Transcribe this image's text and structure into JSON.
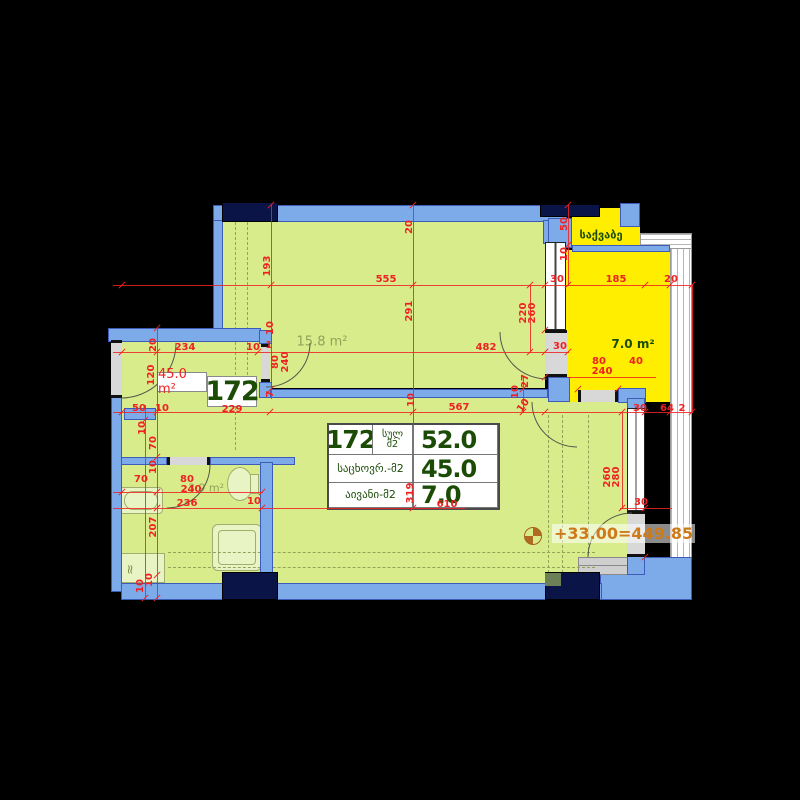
{
  "colors": {
    "wall_blue": "#7dabe9",
    "wall_outline": "#3c5cb8",
    "structure_navy": "#0b1446",
    "floor_green": "#d9ec8c",
    "balcony_yellow": "#ffee00",
    "dimension_red": "#ee2222",
    "label_dark_green": "#1b4c06",
    "label_olive": "#93a259",
    "level_orange": "#cf7a1a",
    "door_gray": "#d8d8d8"
  },
  "apartment": {
    "number": "172",
    "area_badge": "45.0 m²"
  },
  "table": {
    "apt_number": "172",
    "total_label_line1": "სულ",
    "total_label_line2": "მ2",
    "total_value": "52.0",
    "living_label": "საცხოვრ.-მ2",
    "living_value": "45.0",
    "balcony_label": "აივანი-მ2",
    "balcony_value": "7.0"
  },
  "level_mark": {
    "text": "+33.00=449.85"
  },
  "washer_symbol": "≈",
  "room_labels": [
    {
      "t": "15.8 m²",
      "x": 322,
      "y": 342,
      "c": "olive",
      "s": 13
    },
    {
      "t": "3.9 m²",
      "x": 206,
      "y": 488,
      "c": "olive",
      "s": 11
    },
    {
      "t": "7.0 m²",
      "x": 633,
      "y": 344,
      "c": "dg",
      "s": 12
    },
    {
      "t": "საქვაბე",
      "x": 601,
      "y": 235,
      "c": "dg",
      "s": 11
    }
  ],
  "dimension_labels": [
    {
      "t": "20",
      "x": 410,
      "y": 227,
      "r": -90
    },
    {
      "t": "193",
      "x": 268,
      "y": 266,
      "r": -90
    },
    {
      "t": "555",
      "x": 386,
      "y": 280,
      "r": 0
    },
    {
      "t": "291",
      "x": 410,
      "y": 311,
      "r": -90
    },
    {
      "t": "220",
      "x": 524,
      "y": 313,
      "r": -90
    },
    {
      "t": "260",
      "x": 533,
      "y": 313,
      "r": -90
    },
    {
      "t": "50",
      "x": 565,
      "y": 224,
      "r": -90
    },
    {
      "t": "10",
      "x": 565,
      "y": 254,
      "r": -90
    },
    {
      "t": "30",
      "x": 557,
      "y": 280,
      "r": 0
    },
    {
      "t": "185",
      "x": 616,
      "y": 280,
      "r": 0
    },
    {
      "t": "20",
      "x": 671,
      "y": 280,
      "r": 0
    },
    {
      "t": "20",
      "x": 154,
      "y": 345,
      "r": -90
    },
    {
      "t": "234",
      "x": 185,
      "y": 348,
      "r": 0
    },
    {
      "t": "10",
      "x": 253,
      "y": 348,
      "r": 0
    },
    {
      "t": "10",
      "x": 271,
      "y": 328,
      "r": -90
    },
    {
      "t": "1",
      "x": 269,
      "y": 346,
      "r": 0
    },
    {
      "t": "482",
      "x": 486,
      "y": 348,
      "r": 0
    },
    {
      "t": "30",
      "x": 560,
      "y": 347,
      "r": 0
    },
    {
      "t": "120",
      "x": 152,
      "y": 375,
      "r": -90
    },
    {
      "t": "80",
      "x": 276,
      "y": 362,
      "r": -90
    },
    {
      "t": "240",
      "x": 286,
      "y": 362,
      "r": -90
    },
    {
      "t": "7",
      "x": 271,
      "y": 394,
      "r": -90
    },
    {
      "t": "80",
      "x": 599,
      "y": 362,
      "r": 0
    },
    {
      "t": "240",
      "x": 602,
      "y": 372,
      "r": 0
    },
    {
      "t": "40",
      "x": 636,
      "y": 362,
      "r": 0
    },
    {
      "t": "27",
      "x": 526,
      "y": 381,
      "r": -90
    },
    {
      "t": "10",
      "x": 516,
      "y": 392,
      "r": -90
    },
    {
      "t": "10",
      "x": 524,
      "y": 406,
      "r": -55
    },
    {
      "t": "10",
      "x": 412,
      "y": 400,
      "r": -90
    },
    {
      "t": "50",
      "x": 139,
      "y": 409,
      "r": 0
    },
    {
      "t": "10",
      "x": 162,
      "y": 409,
      "r": 0
    },
    {
      "t": "229",
      "x": 232,
      "y": 410,
      "r": 0
    },
    {
      "t": "567",
      "x": 459,
      "y": 408,
      "r": 0
    },
    {
      "t": "30",
      "x": 640,
      "y": 409,
      "r": 0
    },
    {
      "t": "64",
      "x": 667,
      "y": 409,
      "r": 0
    },
    {
      "t": "2",
      "x": 682,
      "y": 409,
      "r": 0
    },
    {
      "t": "10",
      "x": 143,
      "y": 428,
      "r": -90
    },
    {
      "t": "70",
      "x": 154,
      "y": 443,
      "r": -90
    },
    {
      "t": "10",
      "x": 154,
      "y": 467,
      "r": -90
    },
    {
      "t": "70",
      "x": 141,
      "y": 480,
      "r": 0
    },
    {
      "t": "80",
      "x": 187,
      "y": 480,
      "r": 0
    },
    {
      "t": "240",
      "x": 191,
      "y": 490,
      "r": 0
    },
    {
      "t": "236",
      "x": 187,
      "y": 504,
      "r": 0
    },
    {
      "t": "10",
      "x": 254,
      "y": 502,
      "r": 0
    },
    {
      "t": "207",
      "x": 154,
      "y": 527,
      "r": -90
    },
    {
      "t": "260",
      "x": 608,
      "y": 477,
      "r": -90
    },
    {
      "t": "280",
      "x": 617,
      "y": 477,
      "r": -90
    },
    {
      "t": "30",
      "x": 641,
      "y": 503,
      "r": 0
    },
    {
      "t": "319",
      "x": 411,
      "y": 493,
      "r": -90
    },
    {
      "t": "610",
      "x": 447,
      "y": 505,
      "r": 0
    },
    {
      "t": "10",
      "x": 150,
      "y": 580,
      "r": -90
    },
    {
      "t": "10",
      "x": 141,
      "y": 586,
      "r": -90
    }
  ],
  "dimension_lines": [
    {
      "x": 113,
      "y": 285,
      "w": 580,
      "h": 1
    },
    {
      "x": 113,
      "y": 352,
      "w": 456,
      "h": 1
    },
    {
      "x": 113,
      "y": 412,
      "w": 580,
      "h": 1
    },
    {
      "x": 568,
      "y": 377,
      "w": 88,
      "h": 1
    },
    {
      "x": 113,
      "y": 492,
      "w": 150,
      "h": 1
    },
    {
      "x": 113,
      "y": 508,
      "w": 352,
      "h": 1
    },
    {
      "x": 620,
      "y": 508,
      "w": 52,
      "h": 1
    },
    {
      "x": 157,
      "y": 328,
      "w": 1,
      "h": 272
    },
    {
      "x": 145,
      "y": 405,
      "w": 1,
      "h": 195
    },
    {
      "x": 271,
      "y": 205,
      "w": 1,
      "h": 194
    },
    {
      "x": 413,
      "y": 205,
      "w": 1,
      "h": 305
    },
    {
      "x": 530,
      "y": 285,
      "w": 1,
      "h": 68
    },
    {
      "x": 568,
      "y": 205,
      "w": 1,
      "h": 81
    },
    {
      "x": 622,
      "y": 412,
      "w": 1,
      "h": 97
    },
    {
      "x": 523,
      "y": 377,
      "w": 1,
      "h": 36
    },
    {
      "x": 692,
      "y": 285,
      "w": 1,
      "h": 128
    }
  ],
  "ticks": [
    [
      122,
      285
    ],
    [
      271,
      285
    ],
    [
      413,
      285
    ],
    [
      530,
      285
    ],
    [
      545,
      285
    ],
    [
      568,
      285
    ],
    [
      645,
      285
    ],
    [
      670,
      285
    ],
    [
      692,
      285
    ],
    [
      122,
      352
    ],
    [
      157,
      352
    ],
    [
      258,
      352
    ],
    [
      530,
      352
    ],
    [
      545,
      352
    ],
    [
      568,
      352
    ],
    [
      122,
      412
    ],
    [
      157,
      412
    ],
    [
      270,
      412
    ],
    [
      413,
      412
    ],
    [
      545,
      412
    ],
    [
      622,
      412
    ],
    [
      645,
      412
    ],
    [
      670,
      412
    ],
    [
      692,
      412
    ],
    [
      122,
      492
    ],
    [
      157,
      492
    ],
    [
      262,
      492
    ],
    [
      157,
      508
    ],
    [
      262,
      508
    ],
    [
      413,
      508
    ],
    [
      622,
      508
    ],
    [
      645,
      508
    ],
    [
      271,
      205
    ],
    [
      271,
      389
    ],
    [
      413,
      205
    ],
    [
      568,
      205
    ],
    [
      568,
      245
    ],
    [
      157,
      328
    ],
    [
      157,
      457
    ],
    [
      157,
      575
    ],
    [
      157,
      598
    ],
    [
      145,
      598
    ],
    [
      145,
      420
    ],
    [
      545,
      330
    ],
    [
      545,
      377
    ],
    [
      578,
      389
    ],
    [
      618,
      389
    ],
    [
      645,
      557
    ],
    [
      523,
      389
    ],
    [
      523,
      412
    ]
  ]
}
